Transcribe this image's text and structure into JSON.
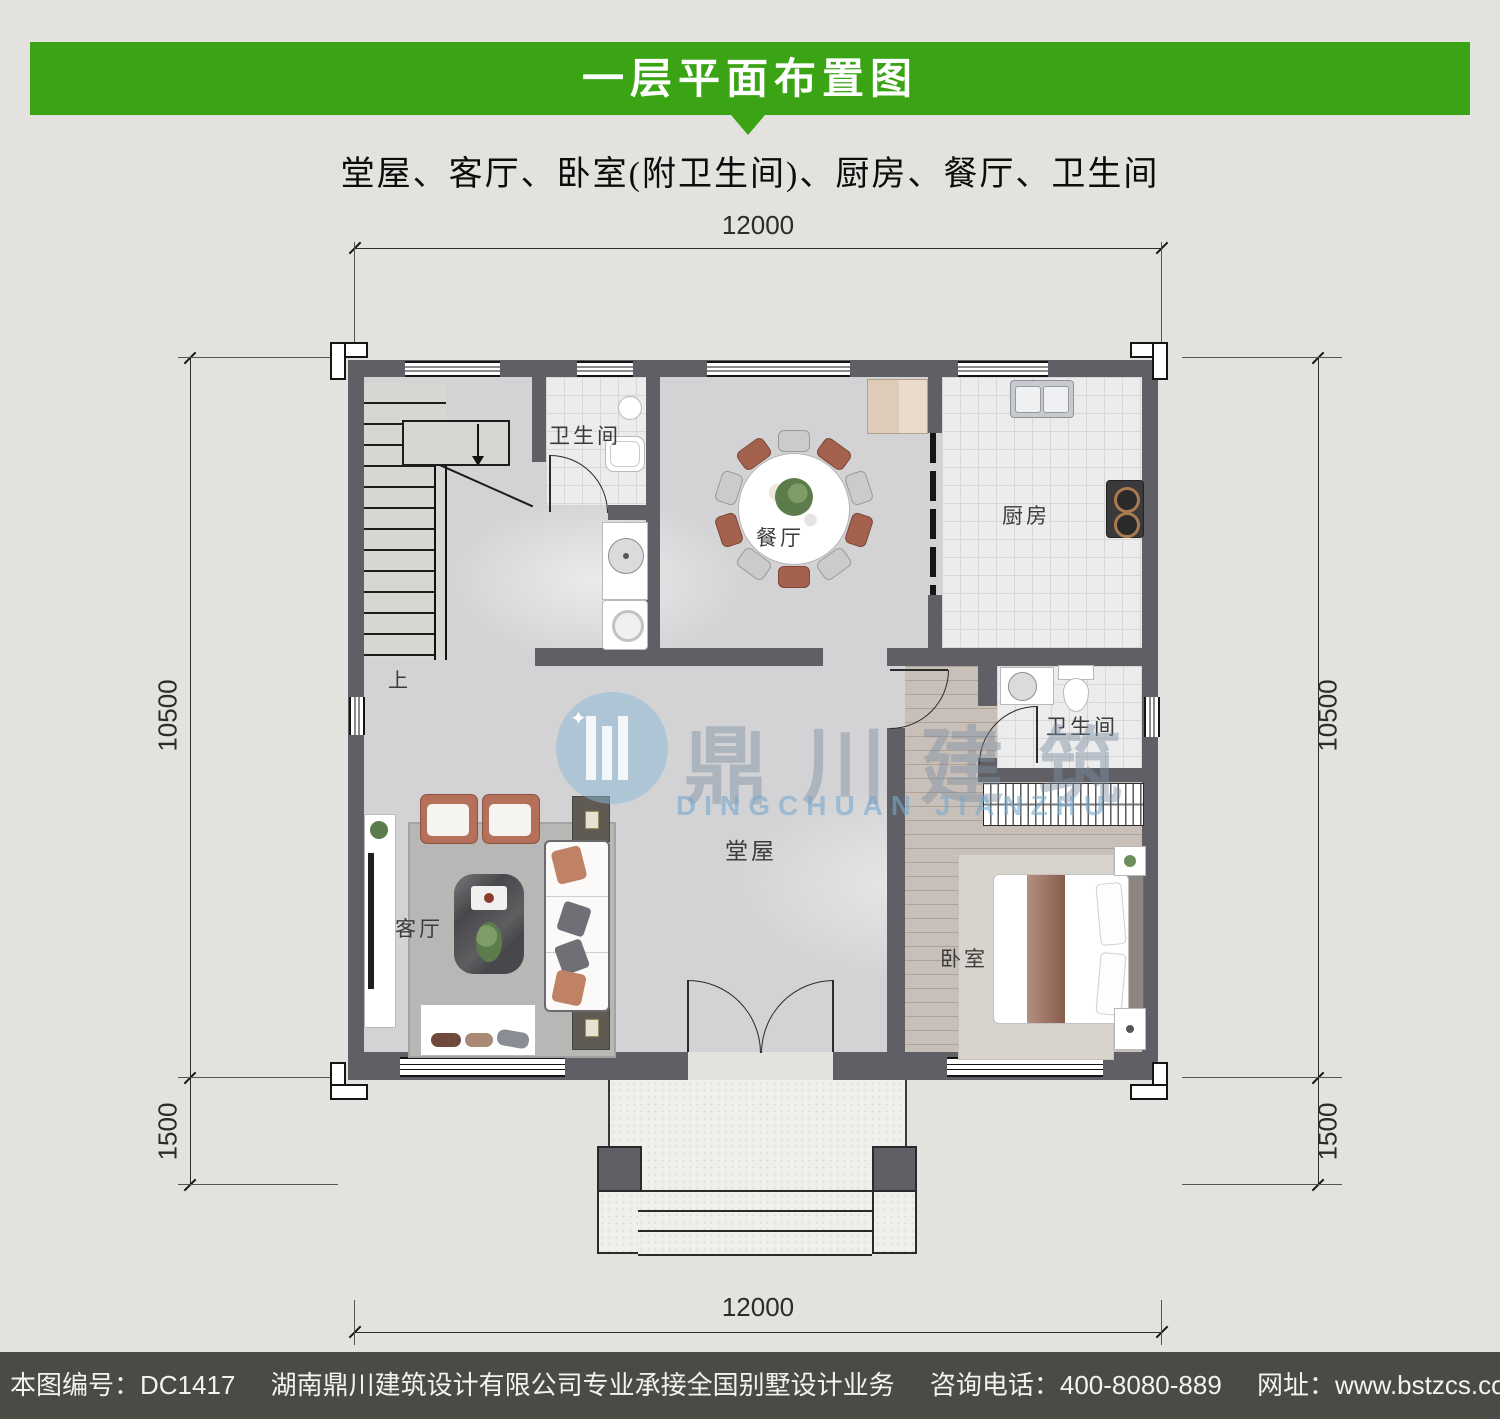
{
  "header": {
    "title": "一层平面布置图"
  },
  "subtitle": "堂屋、客厅、卧室(附卫生间)、厨房、餐厅、卫生间",
  "dimensions": {
    "top": "12000",
    "bottom": "12000",
    "left_main": "10500",
    "left_lower": "1500",
    "right_main": "10500",
    "right_lower": "1500"
  },
  "rooms": {
    "bath1": "卫生间",
    "dining": "餐厅",
    "kitchen": "厨房",
    "bath2": "卫生间",
    "living": "客厅",
    "hall": "堂屋",
    "bedroom": "卧室",
    "stairs_up": "上"
  },
  "watermark": {
    "cn": "鼎川建筑",
    "en": "DINGCHUAN JIANZHU"
  },
  "footer": {
    "plan_no": "本图编号：DC1417",
    "company": "湖南鼎川建筑设计有限公司专业承接全国别墅设计业务",
    "phone": "咨询电话：400-8080-889",
    "website": "网址：www.bstzcs.com"
  },
  "colors": {
    "banner_green": "#3aa414",
    "footer_gray": "#4b4a45",
    "wall": "#5f5f65",
    "page_bg": "#e3e2de"
  }
}
